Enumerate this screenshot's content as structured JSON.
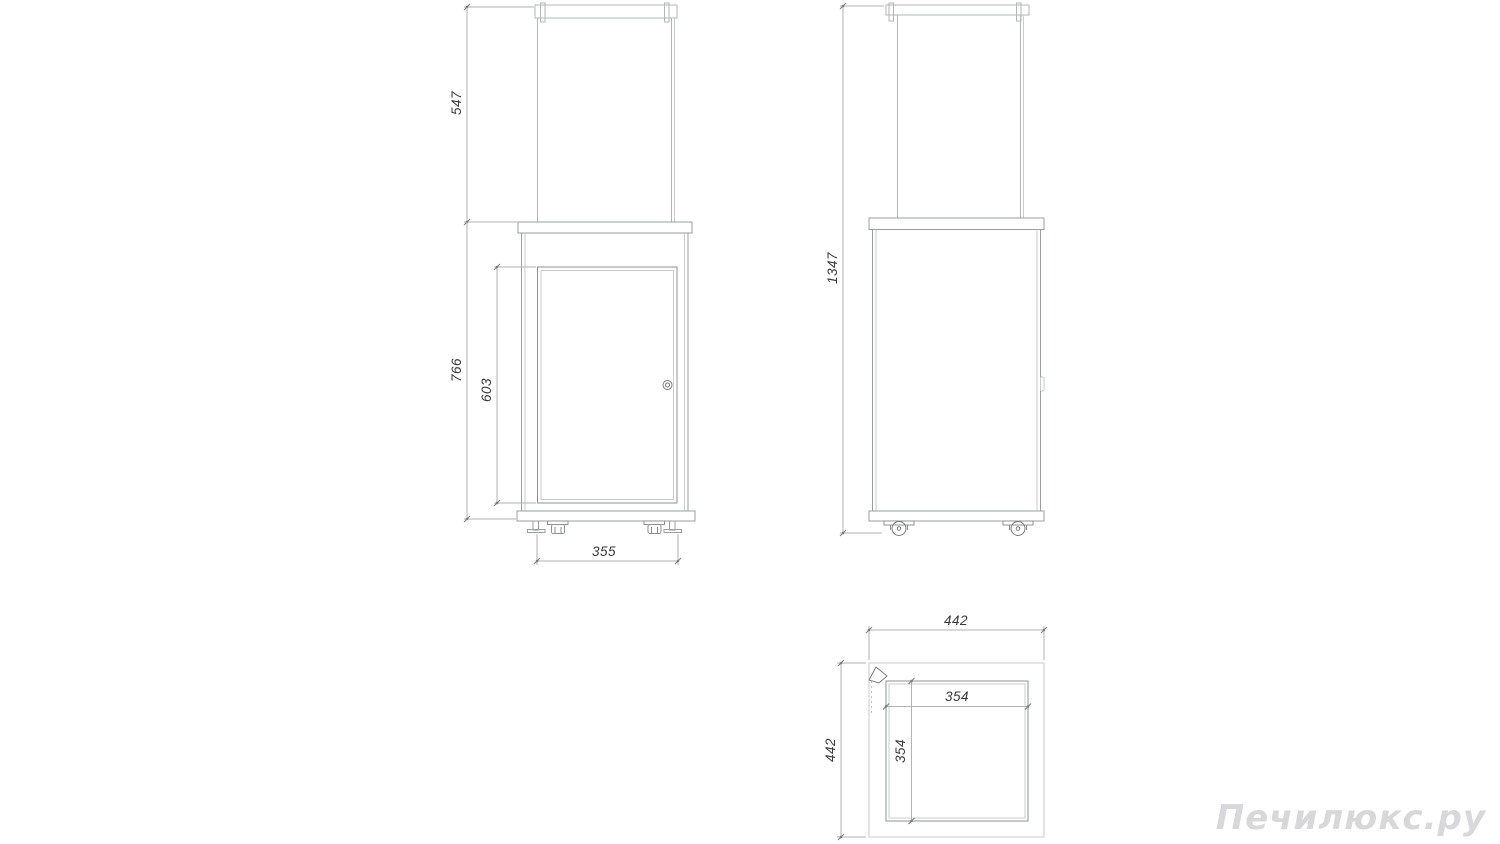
{
  "drawing": {
    "kind": "three-view technical dimension drawing of a gas patio heater with glass column, cabinet door and casters",
    "views": {
      "front": {
        "dims": {
          "glass_height": "547",
          "body_height": "766",
          "door_height": "603",
          "base_width": "355"
        }
      },
      "side": {
        "dims": {
          "total_height": "1347"
        }
      },
      "top": {
        "dims": {
          "outer_width": "442",
          "outer_depth": "442",
          "inner_width": "354",
          "inner_depth": "354"
        }
      }
    },
    "colors": {
      "background": "#ffffff",
      "line_faint": "#c9cbcd",
      "line_light": "#b3b5b8",
      "line_medium": "#9b9da0",
      "line_dark": "#8e9093",
      "dimension_text": "#38393b",
      "watermark_text": "#d8d8da"
    }
  },
  "watermark": {
    "text": "Печилюкс.ру"
  }
}
